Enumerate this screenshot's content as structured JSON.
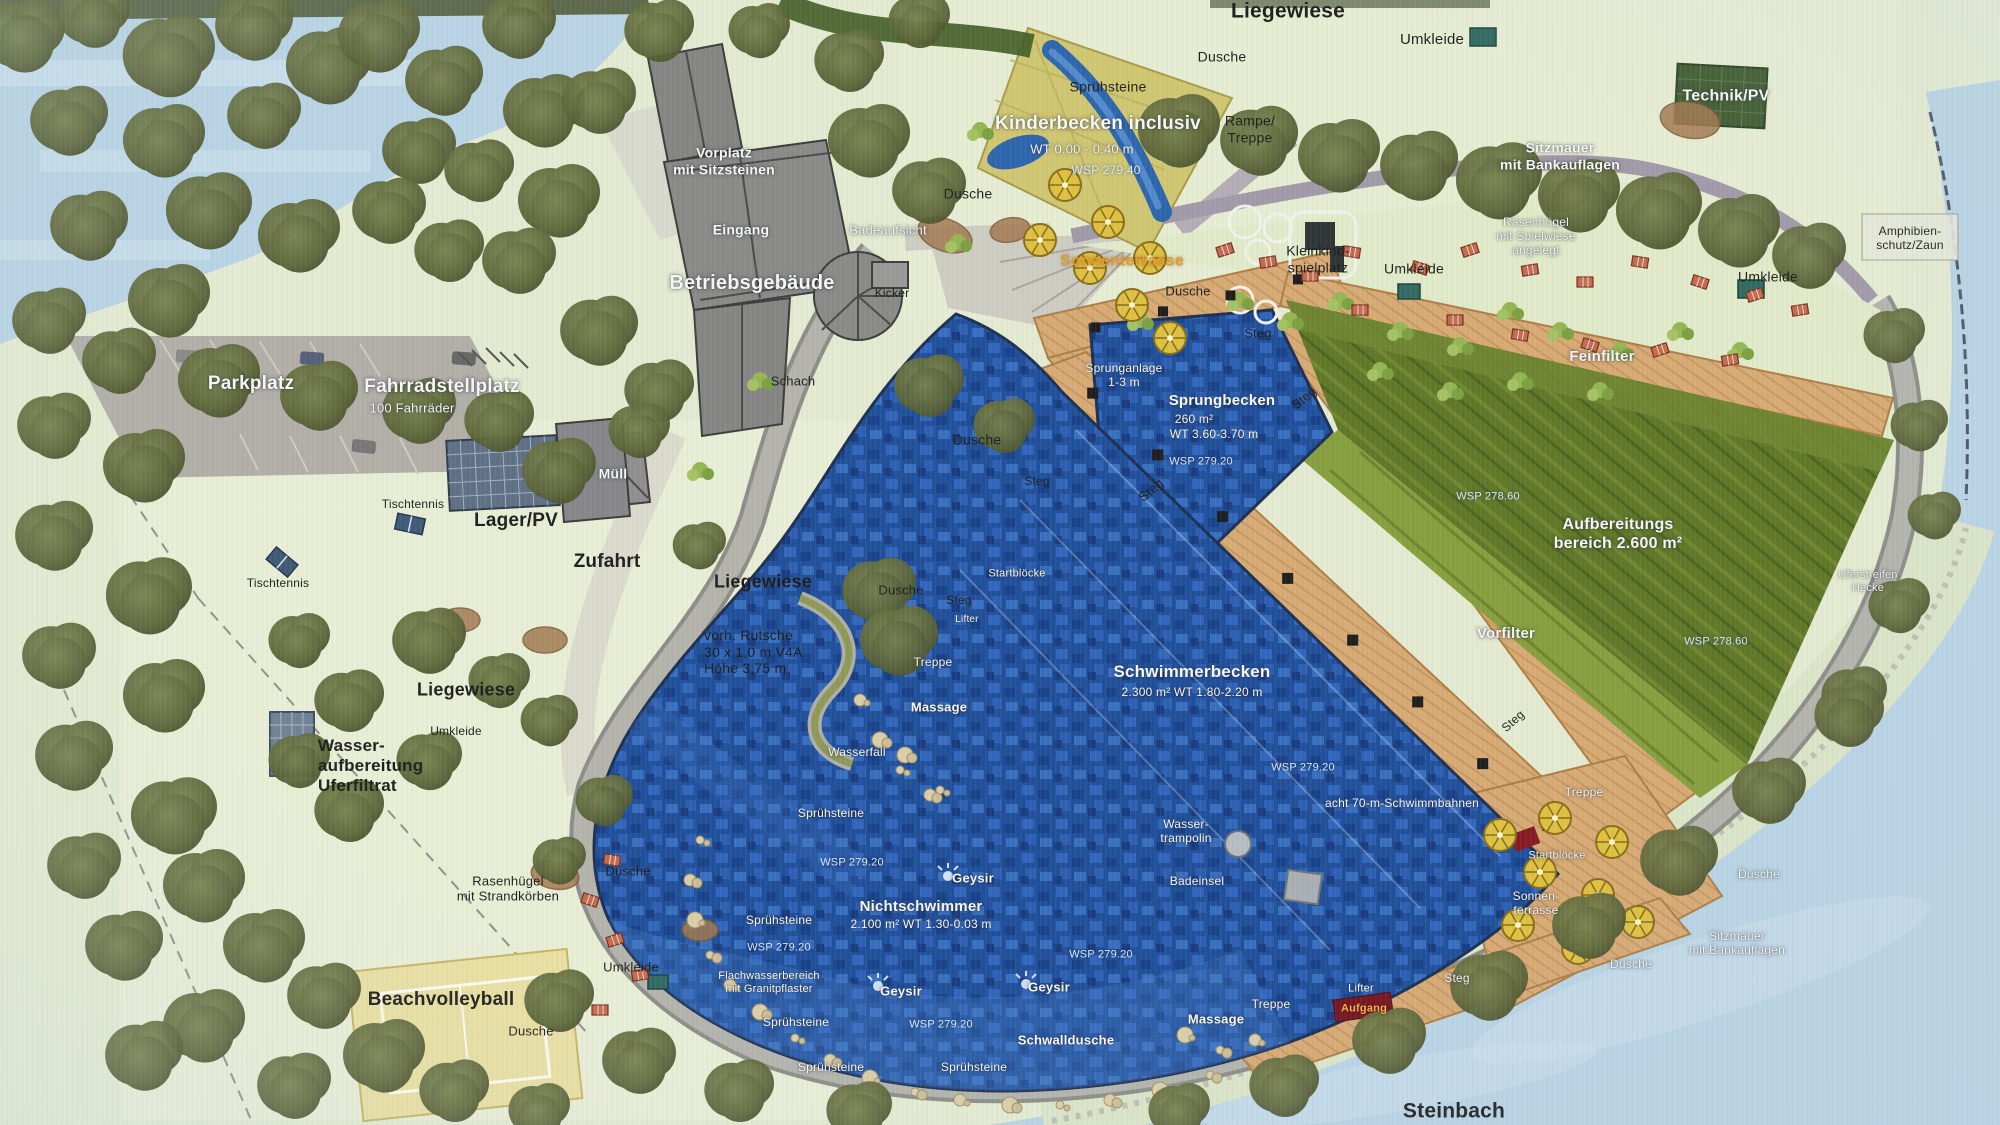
{
  "plan": {
    "kind": "Lageplan Naturbad",
    "stream_name": "Steinbach"
  },
  "palette": {
    "land": "#e6edd2",
    "lawn_light": "#eef2d9",
    "water_lake": "#b9d6e8",
    "pool_blue": "#1d4fa0",
    "pool_blue_light": "#3a74cc",
    "kinder_yellow": "#d2c96e",
    "filter_green": "#5f7823",
    "deck_wood": "#dcab72",
    "path_gray": "#a6a6a0",
    "wall_purple": "#a29aab",
    "building_gray": "#8a8a88",
    "tree_green": "#5c6636",
    "umbrella_yellow": "#e3c23a",
    "label_white": "#fbfbf6",
    "label_dark": "#1d1d1b",
    "wsp_blue": "#d9ecfb",
    "accent_orange": "#e99d22"
  },
  "labels": [
    {
      "t": "Liegewiese",
      "x": 1288,
      "y": 12,
      "s": 21,
      "cls": "dk",
      "b": 1
    },
    {
      "t": "Dusche",
      "x": 1222,
      "y": 57,
      "s": 14,
      "cls": "dk"
    },
    {
      "t": "Umkleide",
      "x": 1432,
      "y": 40,
      "s": 15,
      "cls": "dk"
    },
    {
      "t": "Technik/PV",
      "x": 1726,
      "y": 97,
      "s": 16,
      "cls": "wt",
      "b": 1
    },
    {
      "t": "Sprühsteine",
      "x": 1108,
      "y": 87,
      "s": 14,
      "cls": "dk"
    },
    {
      "t": "Kinderbecken inclusiv",
      "x": 1098,
      "y": 124,
      "s": 19,
      "cls": "wt",
      "b": 1
    },
    {
      "t": "WT 0.00 - 0.40 m",
      "x": 1082,
      "y": 149,
      "s": 13,
      "cls": "wt"
    },
    {
      "t": "WSP 279.40",
      "x": 1106,
      "y": 170,
      "s": 12,
      "cls": "wsp"
    },
    {
      "t": "Rampe/\nTreppe",
      "x": 1250,
      "y": 129,
      "s": 14,
      "cls": "dk"
    },
    {
      "t": "Dusche",
      "x": 968,
      "y": 194,
      "s": 14,
      "cls": "dk"
    },
    {
      "t": "Sonnenterrasse",
      "x": 1122,
      "y": 262,
      "s": 16,
      "cls": "or",
      "b": 1
    },
    {
      "t": "Dusche",
      "x": 1188,
      "y": 291,
      "s": 13,
      "cls": "dk"
    },
    {
      "t": "Kleinkind-\nspielplatz",
      "x": 1318,
      "y": 259,
      "s": 14,
      "cls": "dk"
    },
    {
      "t": "Umkleide",
      "x": 1414,
      "y": 269,
      "s": 14,
      "cls": "dk"
    },
    {
      "t": "Sitzmauer\nmit Bankauflagen",
      "x": 1560,
      "y": 156,
      "s": 14,
      "cls": "wt",
      "b": 1
    },
    {
      "t": "Rasenhügel\nmit Spielwiese\nangelegt",
      "x": 1536,
      "y": 236,
      "s": 12,
      "cls": "wt"
    },
    {
      "t": "Umkleide",
      "x": 1768,
      "y": 277,
      "s": 14,
      "cls": "dk"
    },
    {
      "t": "Amphibien-\nschutz/Zaun",
      "x": 1910,
      "y": 238,
      "s": 12,
      "cls": "dk"
    },
    {
      "t": "Feinfilter",
      "x": 1602,
      "y": 357,
      "s": 15,
      "cls": "wt",
      "b": 1
    },
    {
      "t": "Vorplatz\nmit Sitzsteinen",
      "x": 724,
      "y": 161,
      "s": 14,
      "cls": "wt",
      "b": 1
    },
    {
      "t": "Eingang",
      "x": 741,
      "y": 230,
      "s": 14,
      "cls": "wt",
      "b": 1
    },
    {
      "t": "Betriebsgebäude",
      "x": 752,
      "y": 284,
      "s": 20,
      "cls": "wt",
      "b": 1
    },
    {
      "t": "Badeaufsicht",
      "x": 888,
      "y": 230,
      "s": 13,
      "cls": "wt"
    },
    {
      "t": "Kicker",
      "x": 892,
      "y": 293,
      "s": 12,
      "cls": "dk"
    },
    {
      "t": "Schach",
      "x": 793,
      "y": 381,
      "s": 13,
      "cls": "dk"
    },
    {
      "t": "Dusche",
      "x": 977,
      "y": 440,
      "s": 14,
      "cls": "dk"
    },
    {
      "t": "Parkplatz",
      "x": 251,
      "y": 384,
      "s": 19,
      "cls": "wt",
      "b": 1
    },
    {
      "t": "Fahrradstellplatz",
      "x": 442,
      "y": 387,
      "s": 19,
      "cls": "wt",
      "b": 1
    },
    {
      "t": "100 Fahrräder",
      "x": 412,
      "y": 408,
      "s": 13,
      "cls": "wt"
    },
    {
      "t": "Müll",
      "x": 613,
      "y": 474,
      "s": 14,
      "cls": "wt",
      "b": 1
    },
    {
      "t": "Tischtennis",
      "x": 413,
      "y": 504,
      "s": 12,
      "cls": "dk"
    },
    {
      "t": "Lager/PV",
      "x": 516,
      "y": 521,
      "s": 19,
      "cls": "dk",
      "b": 1
    },
    {
      "t": "Zufahrt",
      "x": 607,
      "y": 562,
      "s": 19,
      "cls": "dk",
      "b": 1
    },
    {
      "t": "Tischtennis",
      "x": 278,
      "y": 583,
      "s": 12,
      "cls": "dk"
    },
    {
      "t": "Liegewiese",
      "x": 763,
      "y": 582,
      "s": 18,
      "cls": "dk",
      "b": 1
    },
    {
      "t": "vorh. Rutsche\n30 x 1,0 m V4A\nHöhe 3,75 m",
      "x": 704,
      "y": 652,
      "s": 14,
      "cls": "dk",
      "al": "left"
    },
    {
      "t": "Liegewiese",
      "x": 466,
      "y": 690,
      "s": 18,
      "cls": "dk",
      "b": 1
    },
    {
      "t": "Umkleide",
      "x": 456,
      "y": 731,
      "s": 12,
      "cls": "dk"
    },
    {
      "t": "Wasser-\naufbereitung\nUferfiltrat",
      "x": 318,
      "y": 766,
      "s": 17,
      "cls": "dk",
      "b": 1,
      "al": "left"
    },
    {
      "t": "Rasenhügel\nmit Strandkörben",
      "x": 508,
      "y": 889,
      "s": 13,
      "cls": "dk"
    },
    {
      "t": "Dusche",
      "x": 628,
      "y": 871,
      "s": 13,
      "cls": "dk"
    },
    {
      "t": "Umkleide",
      "x": 631,
      "y": 967,
      "s": 13,
      "cls": "dk"
    },
    {
      "t": "Dusche",
      "x": 531,
      "y": 1031,
      "s": 13,
      "cls": "dk"
    },
    {
      "t": "Beachvolleyball",
      "x": 441,
      "y": 1000,
      "s": 19,
      "cls": "dk",
      "b": 1
    },
    {
      "t": "Steg",
      "x": 1258,
      "y": 333,
      "s": 13,
      "cls": "dk"
    },
    {
      "t": "Sprunganlage\n1-3 m",
      "x": 1124,
      "y": 375,
      "s": 12,
      "cls": "wt"
    },
    {
      "t": "Sprungbecken",
      "x": 1222,
      "y": 401,
      "s": 15,
      "cls": "wt",
      "b": 1
    },
    {
      "t": "260 m²",
      "x": 1194,
      "y": 419,
      "s": 12,
      "cls": "wt"
    },
    {
      "t": "WT 3.60-3.70 m",
      "x": 1214,
      "y": 434,
      "s": 12,
      "cls": "wt"
    },
    {
      "t": "WSP 279.20",
      "x": 1201,
      "y": 462,
      "s": 11,
      "cls": "wsp"
    },
    {
      "t": "Steg",
      "x": 1304,
      "y": 398,
      "s": 13,
      "cls": "dk",
      "rot": -40
    },
    {
      "t": "Steg",
      "x": 1151,
      "y": 490,
      "s": 13,
      "cls": "dk",
      "rot": -40
    },
    {
      "t": "Steg",
      "x": 1037,
      "y": 481,
      "s": 12,
      "cls": "dk"
    },
    {
      "t": "Startblöcke",
      "x": 1017,
      "y": 574,
      "s": 11,
      "cls": "wt"
    },
    {
      "t": "Dusche",
      "x": 901,
      "y": 590,
      "s": 13,
      "cls": "dk"
    },
    {
      "t": "Steg",
      "x": 959,
      "y": 600,
      "s": 12,
      "cls": "dk"
    },
    {
      "t": "Lifter",
      "x": 967,
      "y": 620,
      "s": 10,
      "cls": "wt"
    },
    {
      "t": "Treppe",
      "x": 933,
      "y": 662,
      "s": 12,
      "cls": "wt"
    },
    {
      "t": "Massage",
      "x": 939,
      "y": 707,
      "s": 13,
      "cls": "wt",
      "b": 1
    },
    {
      "t": "Wasserfall",
      "x": 857,
      "y": 752,
      "s": 12,
      "cls": "wt"
    },
    {
      "t": "Sprühsteine",
      "x": 831,
      "y": 813,
      "s": 12,
      "cls": "wt"
    },
    {
      "t": "Schwimmerbecken",
      "x": 1192,
      "y": 672,
      "s": 17,
      "cls": "wt",
      "b": 1
    },
    {
      "t": "2.300 m² WT 1.80-2.20 m",
      "x": 1192,
      "y": 692,
      "s": 12,
      "cls": "wt"
    },
    {
      "t": "WSP 279.20",
      "x": 1303,
      "y": 768,
      "s": 11,
      "cls": "wsp"
    },
    {
      "t": "acht 70-m-Schwimmbahnen",
      "x": 1402,
      "y": 803,
      "s": 12,
      "cls": "wt"
    },
    {
      "t": "Vorfilter",
      "x": 1506,
      "y": 634,
      "s": 15,
      "cls": "wt",
      "b": 1
    },
    {
      "t": "Steg",
      "x": 1513,
      "y": 721,
      "s": 12,
      "cls": "dk",
      "rot": -42
    },
    {
      "t": "Wasser-\ntrampolin",
      "x": 1186,
      "y": 831,
      "s": 12,
      "cls": "wt"
    },
    {
      "t": "Badeinsel",
      "x": 1197,
      "y": 881,
      "s": 12,
      "cls": "wt"
    },
    {
      "t": "WSP 279.20",
      "x": 852,
      "y": 863,
      "s": 11,
      "cls": "wsp"
    },
    {
      "t": "Geysir",
      "x": 973,
      "y": 878,
      "s": 13,
      "cls": "wt",
      "b": 1
    },
    {
      "t": "Nichtschwimmer",
      "x": 921,
      "y": 907,
      "s": 15,
      "cls": "wt",
      "b": 1
    },
    {
      "t": "2.100 m² WT 1.30-0.03 m",
      "x": 921,
      "y": 924,
      "s": 12,
      "cls": "wt"
    },
    {
      "t": "Sprühsteine",
      "x": 779,
      "y": 920,
      "s": 12,
      "cls": "wt"
    },
    {
      "t": "WSP 279.20",
      "x": 779,
      "y": 948,
      "s": 11,
      "cls": "wsp"
    },
    {
      "t": "Flachwasserbereich\nmit Granitpflaster",
      "x": 769,
      "y": 983,
      "s": 11,
      "cls": "wt"
    },
    {
      "t": "Geysir",
      "x": 901,
      "y": 991,
      "s": 13,
      "cls": "wt",
      "b": 1
    },
    {
      "t": "Geysir",
      "x": 1049,
      "y": 987,
      "s": 13,
      "cls": "wt",
      "b": 1
    },
    {
      "t": "WSP 279.20",
      "x": 1101,
      "y": 955,
      "s": 11,
      "cls": "wsp"
    },
    {
      "t": "Sprühsteine",
      "x": 796,
      "y": 1022,
      "s": 12,
      "cls": "wt"
    },
    {
      "t": "WSP 279.20",
      "x": 941,
      "y": 1025,
      "s": 11,
      "cls": "wsp"
    },
    {
      "t": "Sprühsteine",
      "x": 831,
      "y": 1067,
      "s": 12,
      "cls": "wt"
    },
    {
      "t": "Sprühsteine",
      "x": 974,
      "y": 1067,
      "s": 12,
      "cls": "wt"
    },
    {
      "t": "Schwalldusche",
      "x": 1066,
      "y": 1040,
      "s": 13,
      "cls": "wt",
      "b": 1
    },
    {
      "t": "Massage",
      "x": 1216,
      "y": 1019,
      "s": 13,
      "cls": "wt",
      "b": 1
    },
    {
      "t": "Treppe",
      "x": 1271,
      "y": 1004,
      "s": 12,
      "cls": "wt"
    },
    {
      "t": "Lifter",
      "x": 1361,
      "y": 989,
      "s": 11,
      "cls": "wt"
    },
    {
      "t": "Aufgang",
      "x": 1364,
      "y": 1009,
      "s": 11,
      "cls": "og",
      "b": 1
    },
    {
      "t": "Steg",
      "x": 1457,
      "y": 978,
      "s": 12,
      "cls": "wt"
    },
    {
      "t": "Dusche",
      "x": 1631,
      "y": 964,
      "s": 12,
      "cls": "wt"
    },
    {
      "t": "Dusche",
      "x": 1759,
      "y": 874,
      "s": 12,
      "cls": "wt"
    },
    {
      "t": "Sitzmauer\nmit Bankauflagen",
      "x": 1737,
      "y": 943,
      "s": 12,
      "cls": "wt"
    },
    {
      "t": "Treppe",
      "x": 1584,
      "y": 792,
      "s": 12,
      "cls": "wt"
    },
    {
      "t": "Startblöcke",
      "x": 1557,
      "y": 856,
      "s": 11,
      "cls": "wt"
    },
    {
      "t": "Sonnen-\nterrasse",
      "x": 1536,
      "y": 903,
      "s": 12,
      "cls": "wt"
    },
    {
      "t": "Steinbach",
      "x": 1454,
      "y": 1112,
      "s": 21,
      "cls": "dk",
      "b": 1
    },
    {
      "t": "WSP 278.60",
      "x": 1488,
      "y": 497,
      "s": 11,
      "cls": "wsp"
    },
    {
      "t": "Aufbereitungs\nbereich 2.600 m²",
      "x": 1618,
      "y": 535,
      "s": 16,
      "cls": "wt",
      "b": 1
    },
    {
      "t": "WSP 278.60",
      "x": 1716,
      "y": 642,
      "s": 11,
      "cls": "wsp"
    },
    {
      "t": "Uferstreifen\nHecke",
      "x": 1868,
      "y": 582,
      "s": 11,
      "cls": "wt"
    }
  ]
}
